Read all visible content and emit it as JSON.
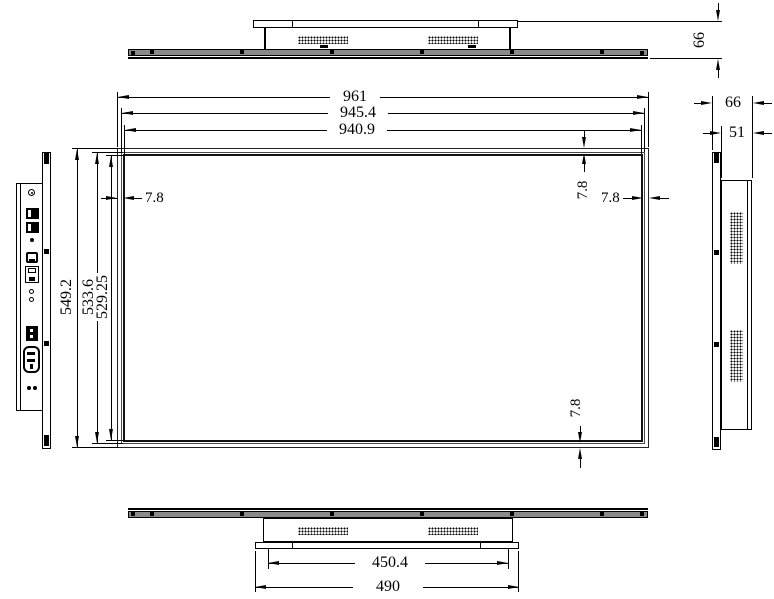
{
  "front_view": {
    "width_dims": [
      "961",
      "945.4",
      "940.9"
    ],
    "height_dims": [
      "549.2",
      "533.6",
      "529.25"
    ],
    "bezel": {
      "left": "7.8",
      "top": "7.8",
      "right": "7.8",
      "bottom": "7.8"
    }
  },
  "top_view": {
    "depth": "66"
  },
  "right_view": {
    "depth_total": "66",
    "depth_body": "51"
  },
  "bottom_view": {
    "inner_width": "450.4",
    "outer_width": "490"
  },
  "colors": {
    "line": "#000000",
    "panel_fill": "#8a8a8a",
    "background": "#ffffff"
  }
}
